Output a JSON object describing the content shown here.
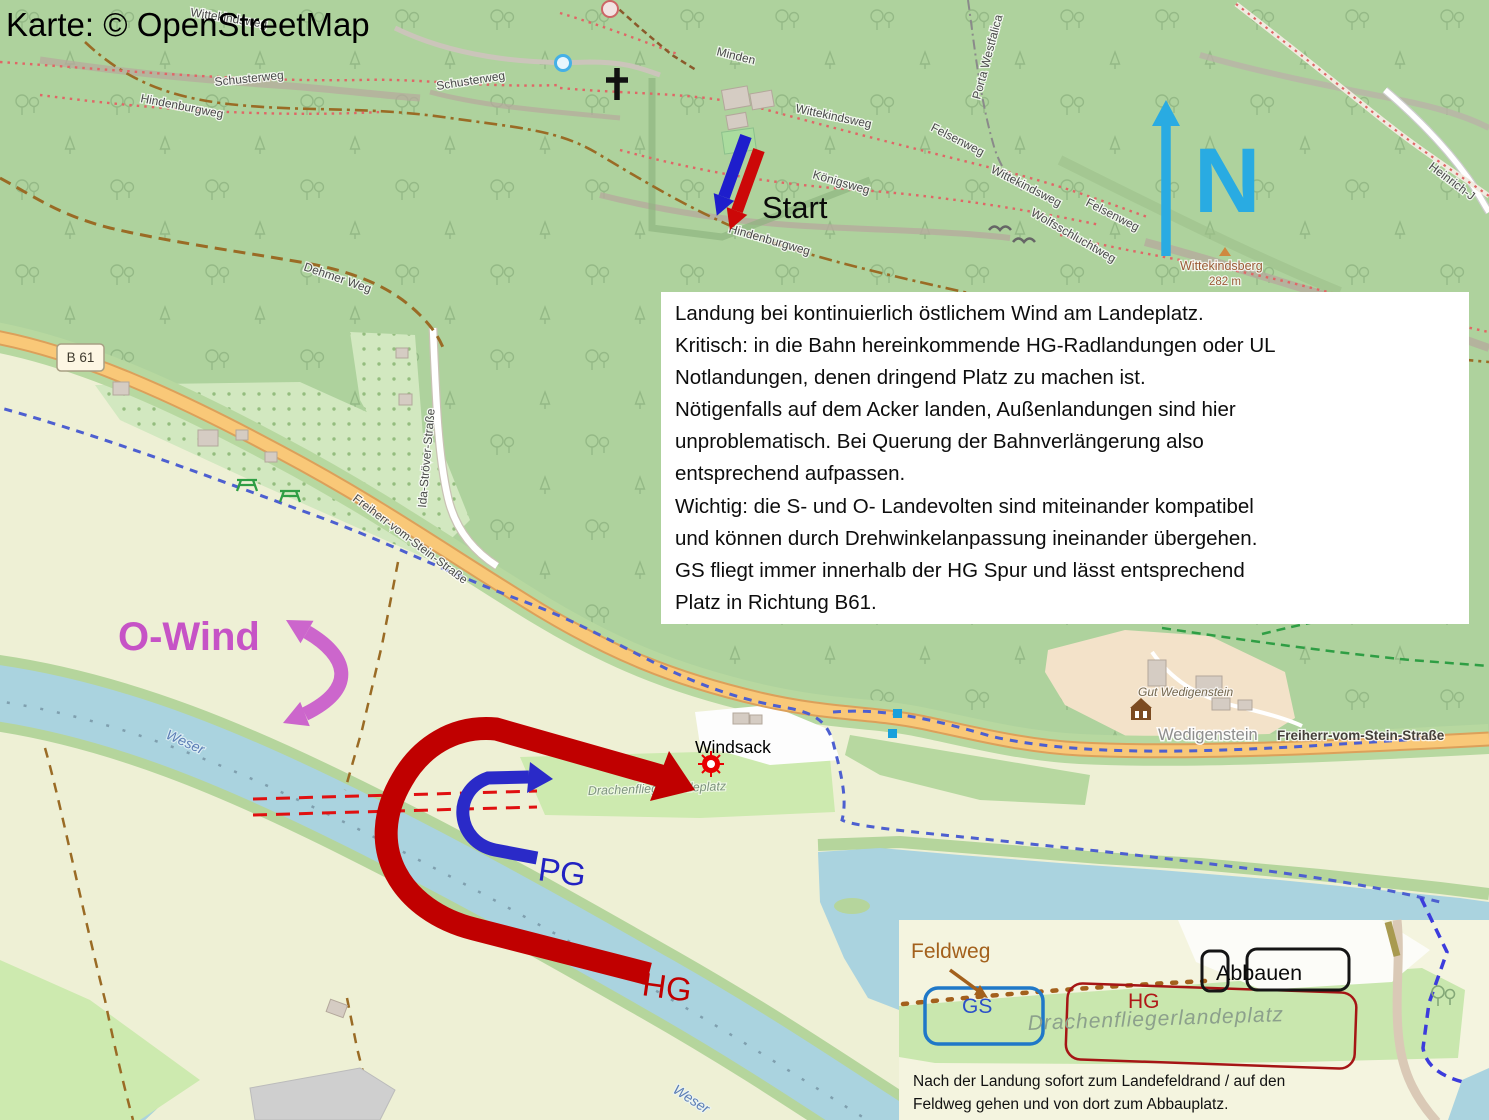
{
  "attribution": "Karte: © OpenStreetMap",
  "annotations": {
    "start": "Start",
    "wind": "O-Wind",
    "pg": "PG",
    "hg": "HG",
    "north": "N",
    "windsock": "Windsack"
  },
  "note_box": {
    "lines": [
      "Landung bei kontinuierlich östlichem Wind am Landeplatz.",
      "Kritisch: in die Bahn hereinkommende HG-Radlandungen oder UL",
      "Notlandungen, denen dringend Platz zu machen ist.",
      "Nötigenfalls auf dem Acker landen, Außenlandungen sind hier",
      "unproblematisch. Bei Querung der Bahnverlängerung also",
      "entsprechend aufpassen.",
      "Wichtig: die S- und O- Landevolten sind miteinander kompatibel",
      "und können durch Drehwinkelanpassung ineinander übergehen.",
      "GS fliegt immer innerhalb der HG Spur und lässt entsprechend",
      "Platz in Richtung B61."
    ]
  },
  "inset": {
    "feldweg": "Feldweg",
    "gs": "GS",
    "hg": "HG",
    "abbauen": "Abbauen",
    "field_name": "Drachenfliegerlandeplatz",
    "note_lines": [
      "Nach der Landung sofort zum Landefeldrand / auf den",
      "Feldweg gehen und von dort zum Abbauplatz."
    ]
  },
  "map_labels": {
    "wittekindsweg": "Wittekindsweg",
    "schusterweg": "Schusterweg",
    "hindenburgweg": "Hindenburgweg",
    "dehmer_weg": "Dehmer Weg",
    "minden": "Minden",
    "koenigsweg": "Königsweg",
    "felsenweg": "Felsenweg",
    "wolfsschluchtweg": "Wolfsschluchtweg",
    "porta_westfalica": "Porta Westfalica",
    "heinrich": "Heinrich-J",
    "b61": "B 61",
    "freiherr": "Freiherr-vom-Stein-Straße",
    "ida_stroever": "Ida-Ströver-Straße",
    "wedigenstein": "Wedigenstein",
    "gut_wedigenstein": "Gut Wedigenstein",
    "drachenflieger": "Drachenfliegerlandeplatz",
    "weser": "Weser",
    "wittekindsberg": "Wittekindsberg",
    "elevation": "282 m"
  },
  "colors": {
    "forest": "#aed29d",
    "grass": "#cdeaaf",
    "field": "#eef0d5",
    "water": "#aad3df",
    "road": "#f9c878",
    "hg_red": "#c00000",
    "pg_blue": "#2323c8",
    "wind_magenta": "#c653c6",
    "north_blue": "#29abe2",
    "boundary_blue": "#4d5fd0",
    "gs_blue": "#1f78c8",
    "feldweg_brown": "#a3601c"
  }
}
